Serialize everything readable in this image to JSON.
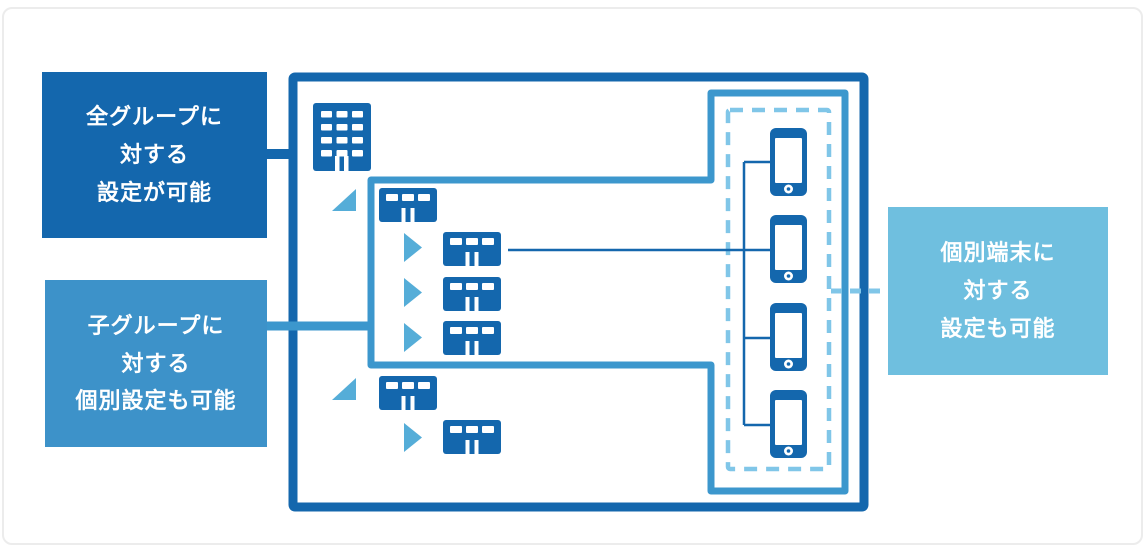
{
  "palette": {
    "dark_blue": "#1467ad",
    "medium_blue": "#3d92c9",
    "light_blue": "#6fbfdf",
    "border_blue": "#3c97cd",
    "dash_blue": "#80c6e8",
    "triangle_blue": "#55add8",
    "card_border": "#ececec"
  },
  "labels": {
    "all_groups": {
      "text": "全グループに対する設定が可能",
      "lines": [
        "全グループに",
        "対する",
        "設定が可能"
      ]
    },
    "child_groups": {
      "text": "子グループに対する個別設定も可能",
      "lines": [
        "子グループに",
        "対する",
        "個別設定も可能"
      ]
    },
    "devices": {
      "text": "個別端末に対する設定も可能",
      "lines": [
        "個別端末に",
        "対する",
        "設定も可能"
      ]
    }
  },
  "icons": {
    "headquarters": "hq-building-icon",
    "group": "branch-building-icon",
    "device": "smartphone-icon",
    "expanded_marker": "expanded-triangle-icon",
    "child_marker": "child-arrow-icon"
  },
  "structure": {
    "headquarters_count": 1,
    "groups": [
      {
        "name": "group-1",
        "child_count": 3
      },
      {
        "name": "group-2",
        "child_count": 1
      }
    ],
    "device_count": 4
  }
}
